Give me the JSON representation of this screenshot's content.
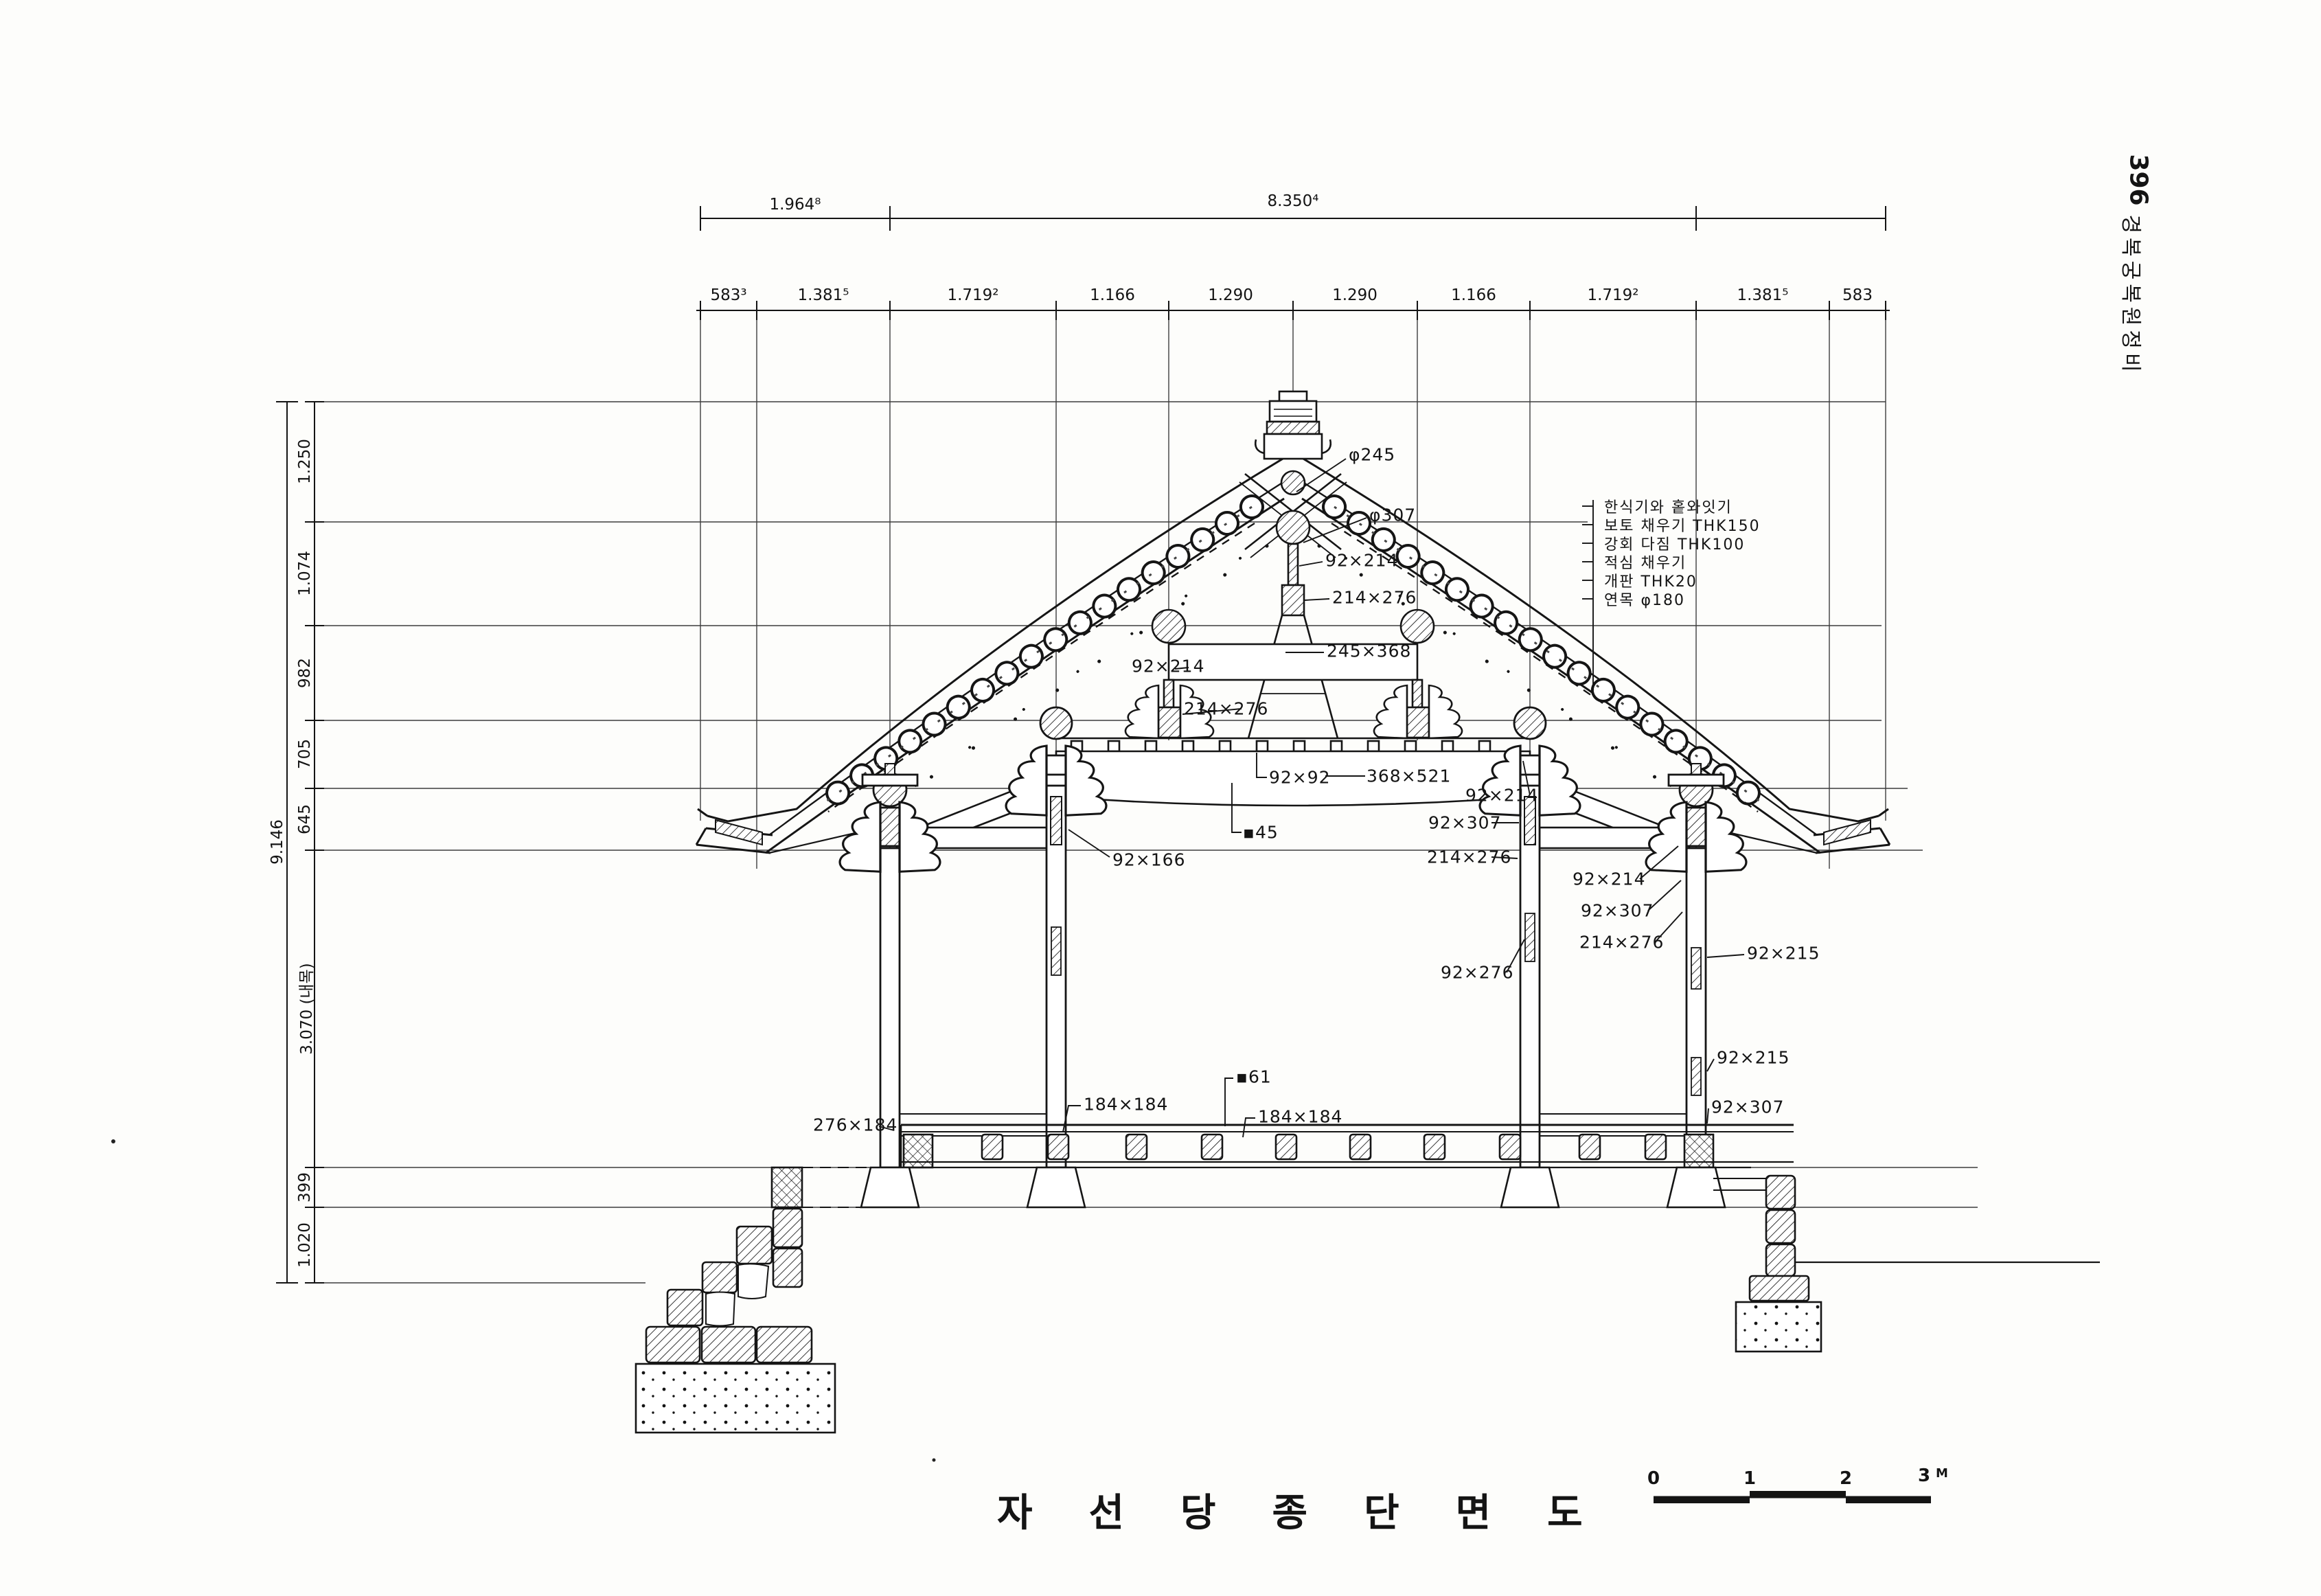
{
  "page": {
    "number": "396",
    "binding_title": "경복궁복원정비"
  },
  "title": "자선당종단면도",
  "scalebar": {
    "ticks": [
      "0",
      "1",
      "2",
      "3"
    ],
    "unit": "M"
  },
  "dims": {
    "top_major": [
      "1.964⁸",
      "8.350⁴"
    ],
    "top_minor": [
      "583³",
      "1.381⁵",
      "1.719²",
      "1.166",
      "1.290",
      "1.290",
      "1.166",
      "1.719²",
      "1.381⁵",
      "583"
    ],
    "left_total": "9.146",
    "left": [
      "1.250",
      "1.074",
      "982",
      "705",
      "645",
      "3.070 (내목)",
      "399",
      "1.020"
    ]
  },
  "roof_layers": [
    "한식기와 홑와잇기",
    "보토 채우기 THK150",
    "강회 다짐 THK100",
    "적심 채우기",
    "개판 THK20",
    "연목 φ180"
  ],
  "labels": [
    "φ245",
    "φ307",
    "92×214",
    "214×276",
    "92×214",
    "245×368",
    "214×276",
    "92×92",
    "368×521",
    "▪45",
    "92×166",
    "92×214",
    "92×307",
    "214×276",
    "92×214",
    "92×307",
    "214×276",
    "92×276",
    "92×215",
    "92×215",
    "92×307",
    "276×184",
    "184×184",
    "▪61",
    "184×184"
  ]
}
